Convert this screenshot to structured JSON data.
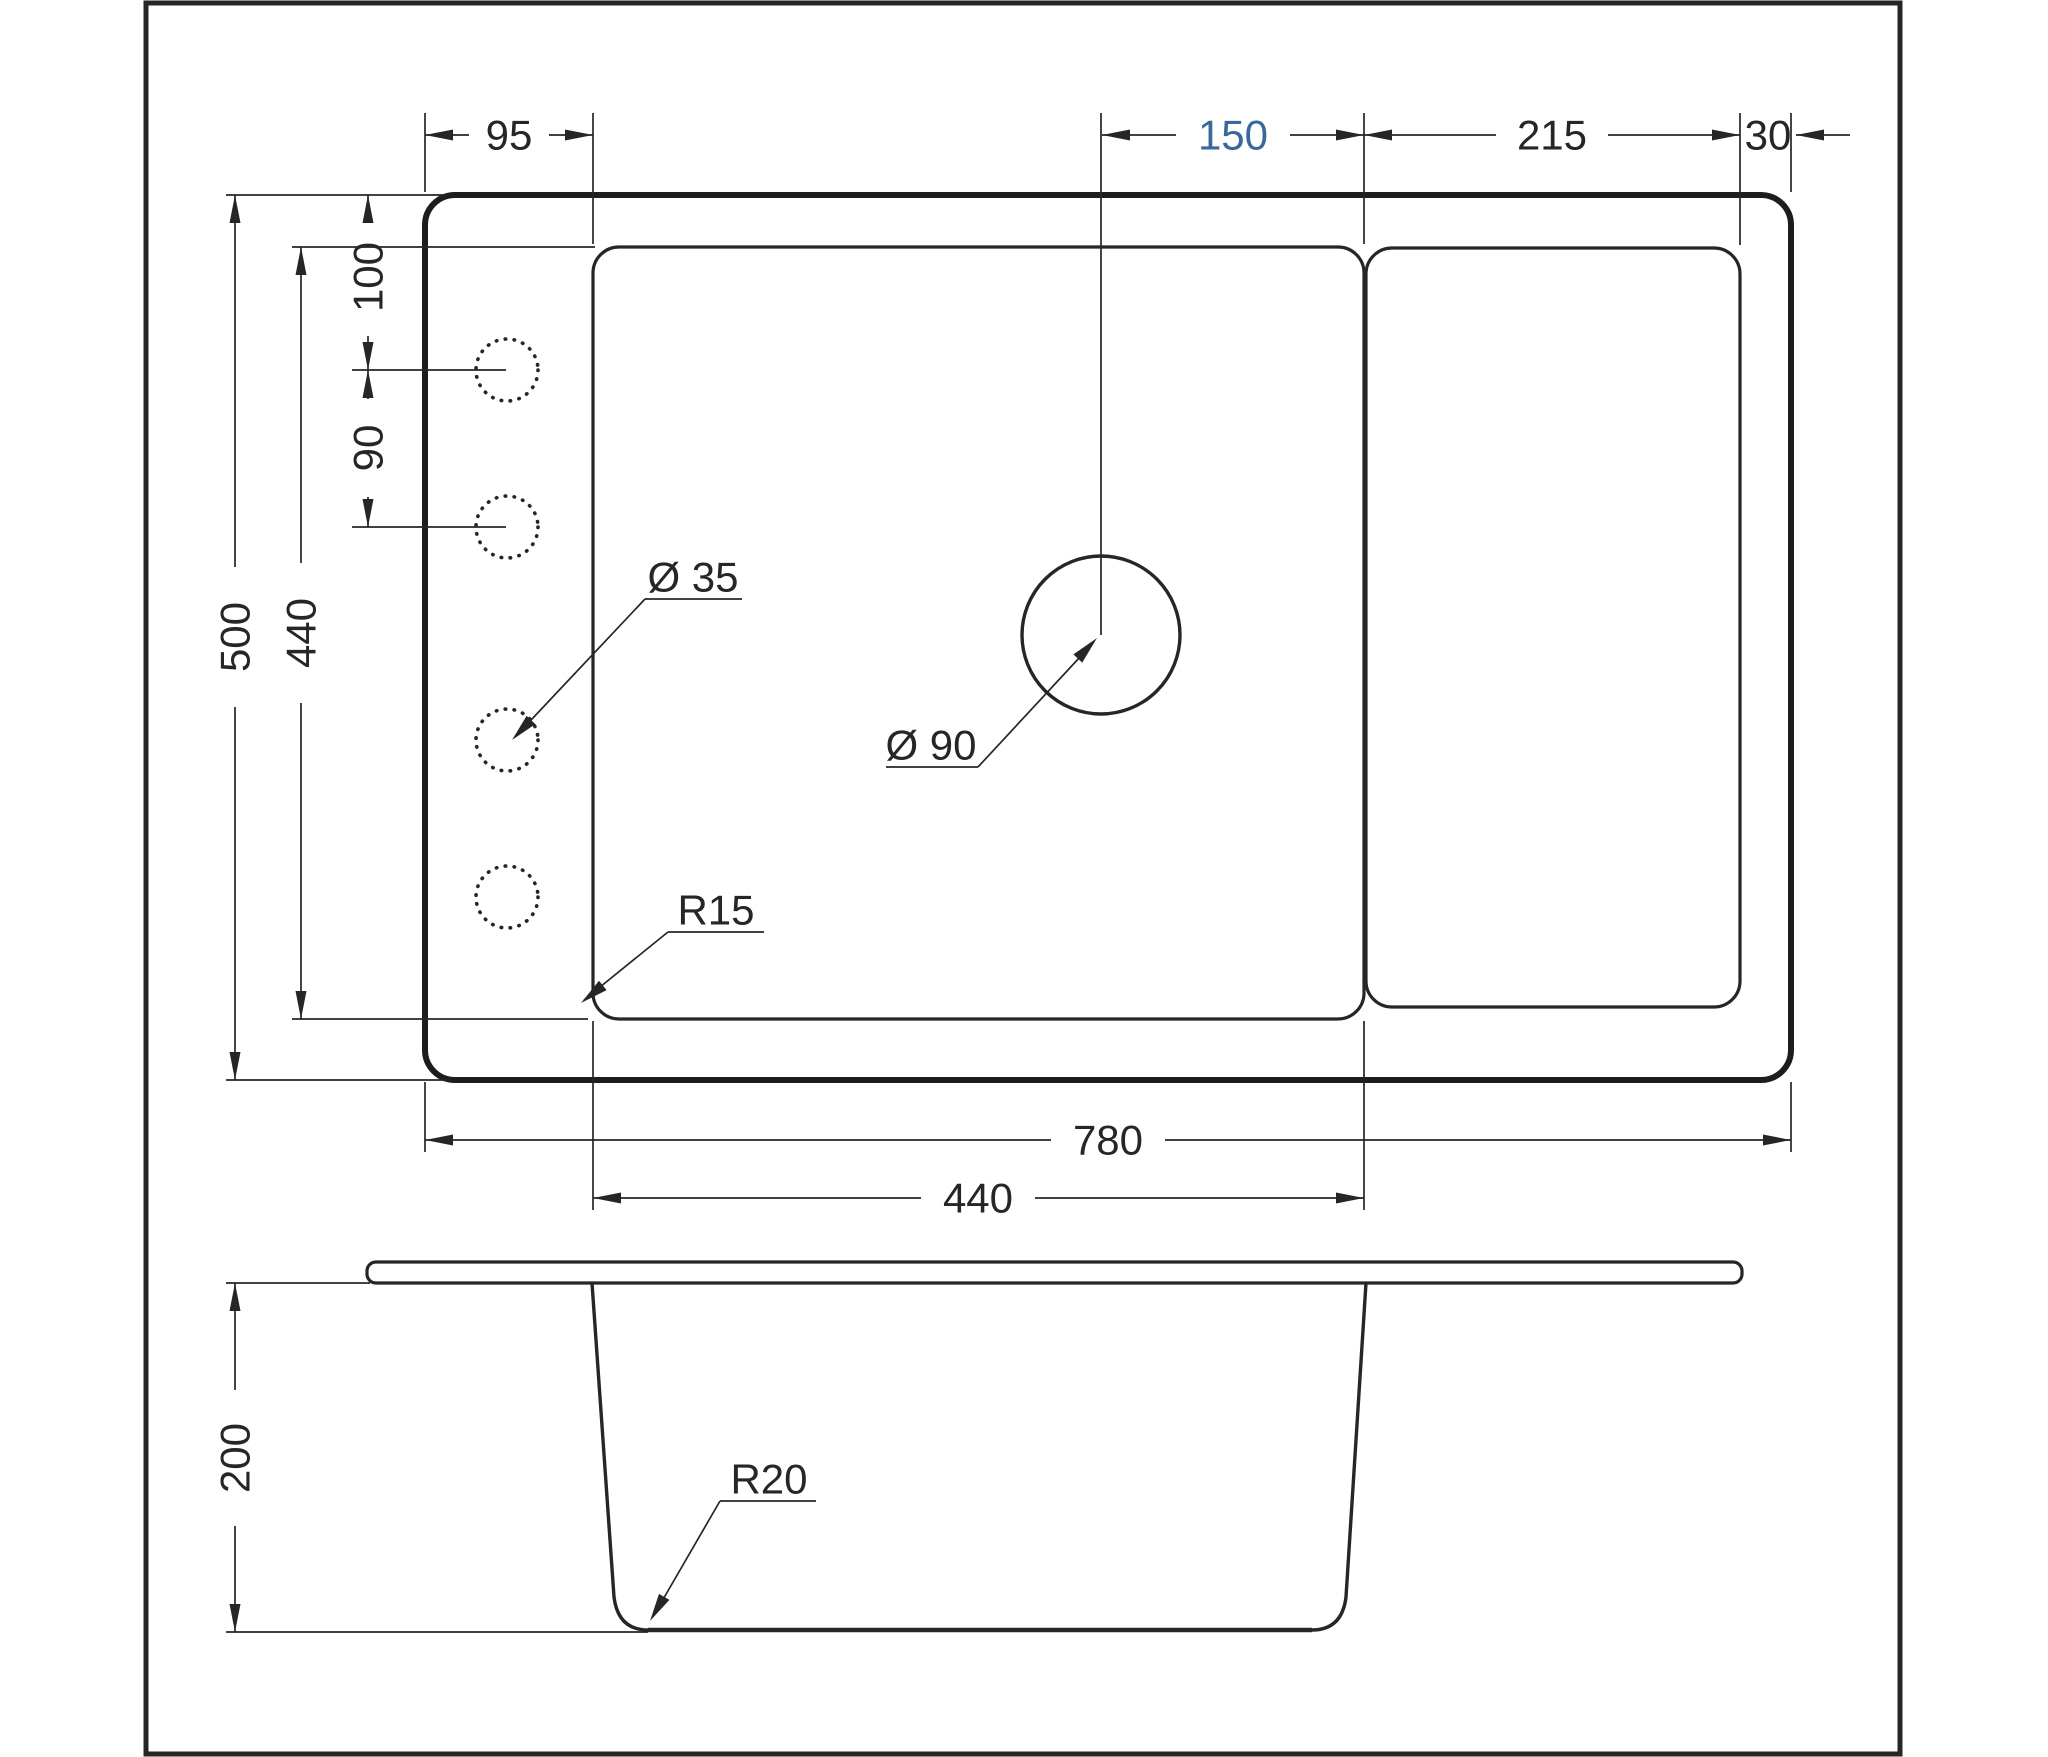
{
  "colors": {
    "ink": "#262626",
    "accent": "#38699e",
    "paper": "#ffffff"
  },
  "plan_view": {
    "top_dims": {
      "rim_to_bowl": "95",
      "drain_to_bowl_right": "150",
      "drainboard_width": "215",
      "right_margin": "30"
    },
    "left_dims": {
      "overall_depth": "500",
      "bowl_depth": "440",
      "top_to_hole1": "100",
      "hole1_to_hole2": "90"
    },
    "bottom_dims": {
      "overall_width": "780",
      "bowl_width": "440"
    },
    "annotations": {
      "faucet_hole_diameter": "Ø 35",
      "drain_diameter": "Ø 90",
      "bowl_corner_radius": "R15"
    }
  },
  "section_view": {
    "dims": {
      "bowl_height": "200"
    },
    "annotations": {
      "bottom_radius": "R20"
    }
  }
}
